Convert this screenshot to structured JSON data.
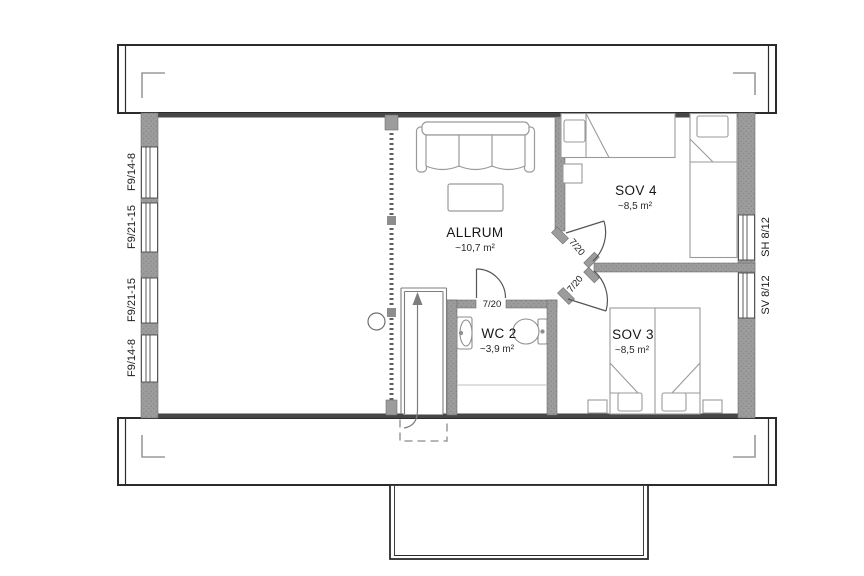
{
  "plan": {
    "title": "upper floor plan",
    "rooms": [
      {
        "name": "ALLRUM",
        "area": "~10,7 m²"
      },
      {
        "name": "SOV 4",
        "area": "~8,5 m²"
      },
      {
        "name": "SOV 3",
        "area": "~8,5 m²"
      },
      {
        "name": "WC 2",
        "area": "~3,9 m²"
      }
    ],
    "windows_left": [
      "F9/14-8",
      "F9/21-15",
      "F9/21-15",
      "F9/14-8"
    ],
    "windows_right": [
      "SH 8/12",
      "SV 8/12"
    ],
    "doors": {
      "sov4": "7/20",
      "sov3": "7/20",
      "wc2": "7/20"
    },
    "colors": {
      "wall": "#9c9c9c",
      "wall_dot": "#848484",
      "outline": "#3a3a3a",
      "band_border": "#2b2b2b",
      "furniture": "#9a9a9a",
      "text": "#161616"
    }
  }
}
